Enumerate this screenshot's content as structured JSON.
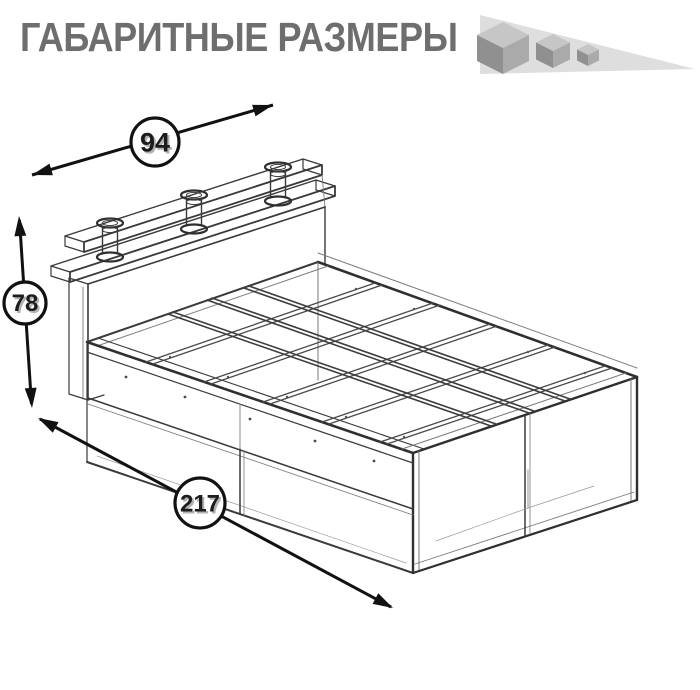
{
  "header": {
    "title": "ГАБАРИТНЫЕ РАЗМЕРЫ"
  },
  "logo_icon": {
    "name": "three-shrinking-cubes"
  },
  "diagram": {
    "dimensions": {
      "width": "94",
      "height": "78",
      "length": "217"
    }
  },
  "colors": {
    "title": "#6e6e6e",
    "line_dark": "#2f2f2f",
    "line_medium": "#4a4a4a",
    "line_light": "#7a7a7a",
    "annotation": "#111111",
    "icon_backdrop": "#dedede",
    "cube_top": "#c6c6c6",
    "cube_left": "#909090",
    "cube_right": "#aaaaaa",
    "background": "#ffffff"
  }
}
